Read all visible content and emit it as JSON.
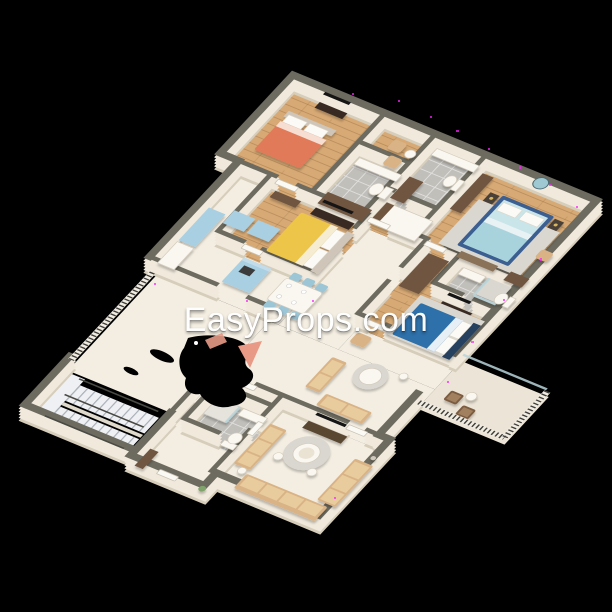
{
  "scene": {
    "background": "#000000",
    "description": "3D isometric floor plan render of a four-bedroom apartment, viewed from above at an angle, on a black background"
  },
  "watermark": {
    "text": "EasyProps.com",
    "color": "#ffffff"
  },
  "palette": {
    "background": "#000000",
    "wall_face": "#f0e9dc",
    "wall_top": "#6d6b5f",
    "wall_shade": "#d6cdbb",
    "floor_cream": "#f4eee2",
    "floor_wood": "#d7a974",
    "floor_tile": "#c1bfba",
    "floor_terrace": "#ece5d7",
    "floor_stairs": "#eef0f3",
    "bed_orange": "#e07a58",
    "bed_yellow": "#ecc549",
    "bed_blue_frame": "#3b5e91",
    "bed_blue_mattress": "#c9e5e9",
    "bed_blue_duvet": "#a9d3dc",
    "bed_navy": "#2f70a9",
    "kitchen_cabinet": "#a8cfe2",
    "dining_chair": "#9cc6d6",
    "sofa_tan": "#d9b385",
    "sofa_cushion": "#e8cc9e",
    "wardrobe_brown": "#6f5440",
    "console_dark": "#372c22",
    "tv_black": "#151515",
    "white_furn": "#faf7f1",
    "rug_grey": "#dad7d0",
    "rail_dark": "#3f3e3a",
    "glass": "#b9d5db",
    "artifact_pink": "#e89a86",
    "speckle_magenta": "#ff22ff",
    "watermark_color": "#ffffff"
  },
  "rooms": [
    {
      "name": "bedroom-orange",
      "floor": "wood",
      "furniture": [
        "orange double bed",
        "wall tv with console",
        "two tan armchairs",
        "side table"
      ]
    },
    {
      "name": "bathroom-1",
      "floor": "tile",
      "furniture": [
        "toilet",
        "vanity",
        "brown wardrobe"
      ]
    },
    {
      "name": "bathroom-2",
      "floor": "tile",
      "furniture": [
        "toilet",
        "vanity",
        "brown wardrobe"
      ]
    },
    {
      "name": "closet-nook",
      "floor": "wood",
      "furniture": [
        "white wardrobe"
      ]
    },
    {
      "name": "bedroom-light-blue",
      "floor": "wood",
      "furniture": [
        "blue-frame double bed",
        "round wall mirror",
        "two nightstands with lamps",
        "foot bench",
        "dresser",
        "wardrobe",
        "tan chair"
      ]
    },
    {
      "name": "bedroom-yellow",
      "floor": "wood",
      "furniture": [
        "yellow double bed",
        "tv console",
        "dresser"
      ]
    },
    {
      "name": "bedroom-dark-blue",
      "floor": "wood",
      "furniture": [
        "navy double bed",
        "tv console",
        "wardrobe",
        "rug"
      ]
    },
    {
      "name": "ensuite-bathroom",
      "floor": "tile",
      "furniture": [
        "toilet",
        "shower",
        "vanity"
      ]
    },
    {
      "name": "kitchen",
      "floor": "cream",
      "furniture": [
        "light blue cabinets",
        "island with cooktop",
        "fridge"
      ]
    },
    {
      "name": "dining-area",
      "floor": "cream",
      "furniture": [
        "white table with plates",
        "six light blue chairs"
      ]
    },
    {
      "name": "lounge",
      "floor": "cream",
      "furniture": [
        "tan sofas",
        "round white table",
        "armchair"
      ]
    },
    {
      "name": "living-room",
      "floor": "cream",
      "furniture": [
        "u-shaped tan sofas",
        "round coffee table",
        "tv console",
        "side tables"
      ]
    },
    {
      "name": "bathroom-3",
      "floor": "tile",
      "furniture": [
        "shower tray",
        "toilet",
        "vanity"
      ]
    },
    {
      "name": "entry-corridor",
      "floor": "cream",
      "furniture": [
        "cabinet",
        "plant"
      ]
    },
    {
      "name": "staircase",
      "floor": "stairs",
      "furniture": [
        "two stair flights",
        "dark handrails",
        "open-edge railing"
      ]
    },
    {
      "name": "terrace",
      "floor": "terrace",
      "furniture": [
        "two wooden chairs",
        "round side table",
        "baluster railing",
        "glass screen"
      ]
    }
  ],
  "artifacts": {
    "black_blob_present": true,
    "pink_triangle_marks": 2,
    "magenta_edge_speckles": true
  }
}
